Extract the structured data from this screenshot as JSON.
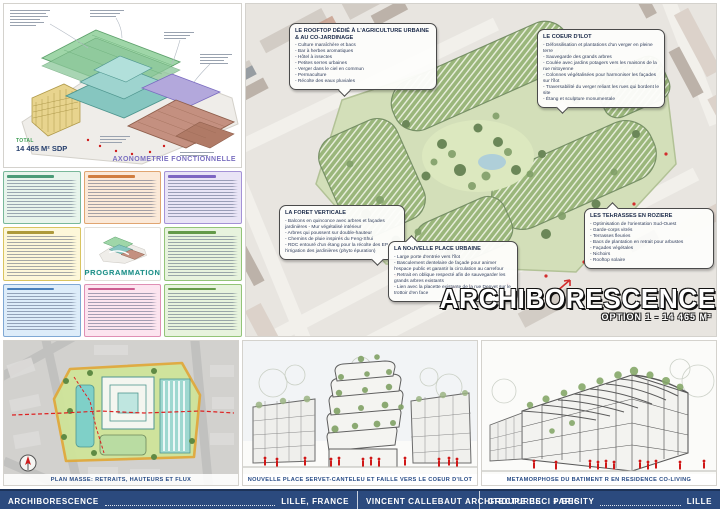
{
  "colors": {
    "footer_bg": "#2b4a7e",
    "accent_red": "#cf1d1d",
    "caption_blue": "#274b85",
    "axon_caption_purple": "#7a6fc0",
    "program_title_teal": "#1f8f88",
    "site_outline_yellow": "#e0a93c",
    "vegetation_green": "#8fae6f"
  },
  "axon_panel": {
    "caption": "AXONOMETRIE FONCTIONNELLE",
    "total_label": "TOTAL",
    "total_area": "14 465 M² SDP"
  },
  "program_panel": {
    "title": "PROGRAMMATION"
  },
  "render_panel": {
    "main_title": "ARCHIBORESCENCE",
    "subtitle": "OPTION 1 - 14 465 M²",
    "callouts": [
      {
        "title": "LE ROOFTOP DÉDIÉ À L'AGRICULTURE URBAINE & AU CO-JARDINAGE",
        "bullets": [
          "- Culture maraîchère et bacs",
          "- Bar à herbes aromatiques",
          "- Hôtel à insectes",
          "- Petites serres urbaines",
          "- Verger dans le ciel en commun",
          "- Permaculture",
          "- Récolte des eaux pluviales"
        ]
      },
      {
        "title": "LE COEUR D'ILOT",
        "bullets": [
          "- Défossilisation et plantations d'un verger en pleine terre",
          "- Sauvegarde des grands arbres",
          "- Coulée avec jardins potagers vers les maisons de la rue mitoyenne",
          "- Colonnes végétalisées pour harmoniser les façades sur l'îlot",
          "- Traversabilité du verger reliant les rues qui bordent le site",
          "- Étang et sculpture monumentale"
        ]
      },
      {
        "title": "LA FORET VERTICALE",
        "bullets": [
          "- Balcons en quinconce avec arbres et façades jardinières - Mur végétalisé intérieur",
          "- Arbres qui poussent sur double-hauteur",
          "- Chemins de pluie inspirés du Feng-Shui",
          "- RDC entouré d'un étang pour la récolte des EP et l'irrigation des jardinières (phyto épuration)"
        ]
      },
      {
        "title": "LA NOUVELLE PLACE URBAINE",
        "bullets": [
          "- Large porte d'entrée vers l'îlot",
          "- Basculement dentelaire de façade pour animer l'espace public et garantir la circulation au carrefour",
          "- Retrait en oblique respecté afin de sauvegarder les grands arbres existants",
          "- Lien avec la placette existante de la rue Denvet sur le trottoir d'en face"
        ]
      },
      {
        "title": "LES TERRASSES EN ROZIERE",
        "bullets": [
          "- Optimisation de l'orientation Sud-Ouest",
          "- Garde-corps vitrés",
          "- Terrasses fleuries",
          "- Bacs de plantation en retrait pour arbustes",
          "- Façades végétales",
          "- Nichoirs",
          "- Rooftop solaire"
        ]
      }
    ]
  },
  "bottom_panels": [
    {
      "caption": "PLAN MASSE: RETRAITS, HAUTEURS ET FLUX"
    },
    {
      "caption": "NOUVELLE PLACE SERVET-CANTELEU ET FAILLE VERS LE COEUR D'ILOT"
    },
    {
      "caption": "METAMORPHOSE DU BATIMENT R EN RESIDENCE CO-LIVING"
    }
  ],
  "footer": {
    "segments": [
      {
        "left": "ARCHIBORESCENCE",
        "right": "LILLE, FRANCE"
      },
      {
        "left": "VINCENT CALLEBAUT ARCHITECTURES",
        "right": "PARIS"
      },
      {
        "left": "GROUPE BECI + BECITY",
        "right": "LILLE"
      }
    ]
  }
}
